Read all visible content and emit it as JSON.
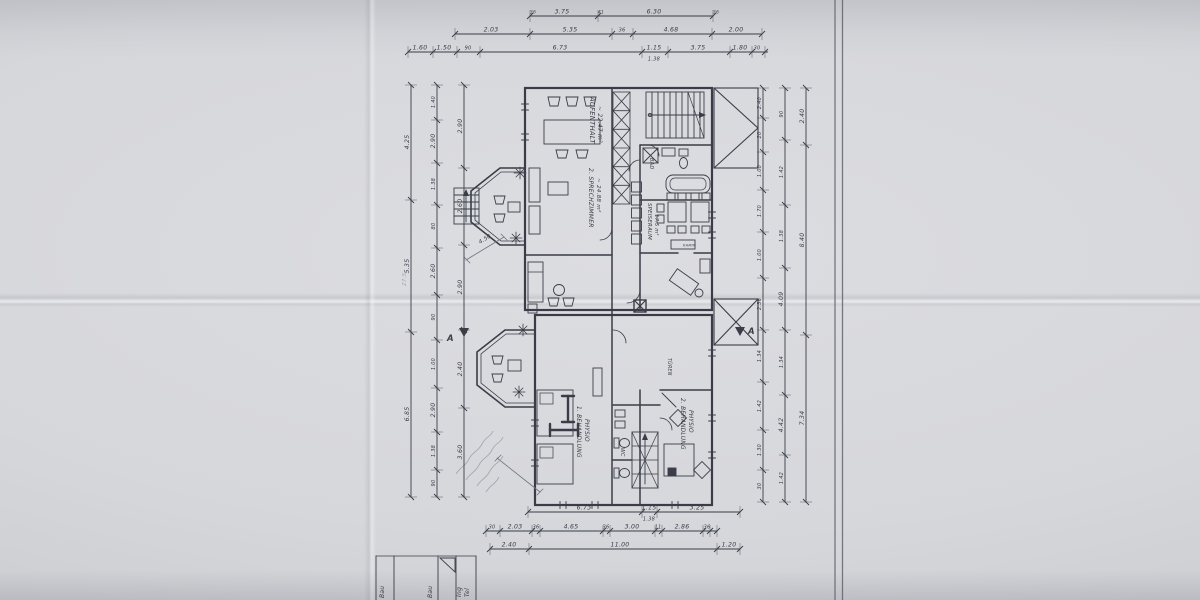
{
  "sheet": {
    "paper_color": "#d7d8dc",
    "ink_color": "#3a3d47",
    "light_ink_color": "#70737c",
    "pencil_color": "#a2a4ad",
    "border_color": "#62656e"
  },
  "plan": {
    "room_labels": [
      {
        "text": "AUFENTHALT",
        "x": 590,
        "y": 97,
        "rot": 90,
        "size": 6.8
      },
      {
        "text": "~ 22.47 m²",
        "x": 598,
        "y": 106,
        "rot": 90,
        "size": 6
      },
      {
        "text": "2. SPRECHZIMMER",
        "x": 589,
        "y": 168,
        "rot": 90,
        "size": 6
      },
      {
        "text": "~ 24.88 m²",
        "x": 597,
        "y": 178,
        "rot": 90,
        "size": 5.6
      },
      {
        "text": "SPEISERAUM",
        "x": 648,
        "y": 203,
        "rot": 90,
        "size": 5.4
      },
      {
        "text": "~ 17.5 m²",
        "x": 655,
        "y": 208,
        "rot": 90,
        "size": 5
      },
      {
        "text": "BAD",
        "x": 650,
        "y": 158,
        "rot": 90,
        "size": 5
      },
      {
        "text": "KAMIN",
        "x": 683,
        "y": 246.5,
        "rot": 0,
        "size": 3.6
      },
      {
        "text": "1. BEHANDLUNG",
        "x": 577,
        "y": 406,
        "rot": 90,
        "size": 5.8
      },
      {
        "text": "PHYSIO",
        "x": 585,
        "y": 419,
        "rot": 90,
        "size": 5.8
      },
      {
        "text": "2. BEHANDLUNG",
        "x": 681,
        "y": 398,
        "rot": 90,
        "size": 5.8
      },
      {
        "text": "PHYSIO",
        "x": 689,
        "y": 410,
        "rot": 90,
        "size": 5.8
      },
      {
        "text": "TÜREN",
        "x": 668,
        "y": 358,
        "rot": 90,
        "size": 4.8
      },
      {
        "text": "WC",
        "x": 621,
        "y": 448,
        "rot": 90,
        "size": 4.8
      }
    ],
    "annotations": [
      {
        "text": "A",
        "x": 447,
        "y": 341,
        "size": 8.5,
        "bold": true
      },
      {
        "text": "A",
        "x": 748,
        "y": 334,
        "size": 8.5,
        "bold": true
      },
      {
        "text": "4.50",
        "x": 480,
        "y": 244,
        "rot": -32,
        "size": 5.6
      },
      {
        "text": "27.5",
        "x": 406,
        "y": 286,
        "rot": -90,
        "size": 5.6,
        "pencil": true
      }
    ]
  },
  "dim_chains": {
    "horizontal": [
      {
        "y": 16,
        "a": 530,
        "b": 713,
        "ticks": [
          530,
          598,
          713
        ],
        "labels": [
          {
            "t": "3.75",
            "at": 562
          },
          {
            "t": "6.30",
            "at": 654
          },
          {
            "t": "36",
            "at": 533,
            "s": 4.5
          },
          {
            "t": "41",
            "at": 601,
            "s": 4.5
          },
          {
            "t": "36",
            "at": 716,
            "s": 4.5
          }
        ]
      },
      {
        "y": 34,
        "a": 455,
        "b": 762,
        "ticks": [
          455,
          530,
          612,
          633,
          712,
          762
        ],
        "labels": [
          {
            "t": "2.03",
            "at": 491
          },
          {
            "t": "5.35",
            "at": 570
          },
          {
            "t": "36",
            "at": 622,
            "s": 5
          },
          {
            "t": "4.68",
            "at": 671
          },
          {
            "t": "2.00",
            "at": 736
          }
        ]
      },
      {
        "y": 52,
        "a": 408,
        "b": 768,
        "ticks": [
          408,
          433,
          457,
          480,
          642,
          668,
          730,
          752,
          765
        ],
        "labels": [
          {
            "t": "1.60",
            "at": 420
          },
          {
            "t": "1.50",
            "at": 444
          },
          {
            "t": "90",
            "at": 468,
            "s": 5
          },
          {
            "t": "6.73",
            "at": 560
          },
          {
            "t": "1.15",
            "at": 654
          },
          {
            "t": "3.75",
            "at": 698
          },
          {
            "t": "1.80",
            "at": 740
          },
          {
            "t": "30",
            "at": 757,
            "s": 5
          }
        ],
        "sub": [
          {
            "t": "1.38",
            "at": 654
          }
        ]
      },
      {
        "y": 512,
        "a": 528,
        "b": 740,
        "ticks": [
          528,
          642,
          657,
          740
        ],
        "labels": [
          {
            "t": "6.73",
            "at": 584
          },
          {
            "t": "1.15",
            "at": 649
          },
          {
            "t": "3.25",
            "at": 697
          }
        ],
        "sub": [
          {
            "t": "1.38",
            "at": 649
          }
        ]
      },
      {
        "y": 531,
        "a": 486,
        "b": 717,
        "ticks": [
          486,
          500,
          532,
          540,
          603,
          610,
          655,
          662,
          703,
          710,
          717
        ],
        "labels": [
          {
            "t": "30",
            "at": 492,
            "s": 5
          },
          {
            "t": "2.03",
            "at": 515
          },
          {
            "t": "36",
            "at": 536,
            "s": 5
          },
          {
            "t": "4.65",
            "at": 571
          },
          {
            "t": "36",
            "at": 606,
            "s": 5
          },
          {
            "t": "3.00",
            "at": 632
          },
          {
            "t": "11",
            "at": 658,
            "s": 5
          },
          {
            "t": "2.86",
            "at": 682
          },
          {
            "t": "36",
            "at": 707,
            "s": 5
          }
        ]
      },
      {
        "y": 549,
        "a": 490,
        "b": 740,
        "ticks": [
          490,
          529,
          717,
          740
        ],
        "labels": [
          {
            "t": "2.40",
            "at": 509
          },
          {
            "t": "11.00",
            "at": 620
          },
          {
            "t": "1.20",
            "at": 729
          }
        ]
      }
    ],
    "vertical": [
      {
        "x": 411,
        "a": 85,
        "b": 497,
        "ticks": [
          85,
          200,
          332,
          497
        ],
        "labels": [
          {
            "t": "4.25",
            "at": 142
          },
          {
            "t": "5.35",
            "at": 266
          },
          {
            "t": "6.85",
            "at": 414
          }
        ]
      },
      {
        "x": 437,
        "a": 85,
        "b": 497,
        "ticks": [
          85,
          120,
          163,
          205,
          248,
          295,
          340,
          388,
          432,
          470,
          497
        ],
        "labels": [
          {
            "t": "1.40",
            "at": 102,
            "s": 5
          },
          {
            "t": "2.90",
            "at": 141
          },
          {
            "t": "1.38",
            "at": 184,
            "s": 5
          },
          {
            "t": "80",
            "at": 226,
            "s": 5
          },
          {
            "t": "2.60",
            "at": 271
          },
          {
            "t": "90",
            "at": 317,
            "s": 5
          },
          {
            "t": "1.00",
            "at": 364,
            "s": 5
          },
          {
            "t": "2.90",
            "at": 410
          },
          {
            "t": "1.38",
            "at": 451,
            "s": 5
          },
          {
            "t": "90",
            "at": 483,
            "s": 5
          }
        ]
      },
      {
        "x": 464,
        "a": 85,
        "b": 497,
        "ticks": [
          85,
          168,
          245,
          330,
          408,
          497
        ],
        "labels": [
          {
            "t": "2.90",
            "at": 126
          },
          {
            "t": "2.60",
            "at": 206
          },
          {
            "t": "2.90",
            "at": 287
          },
          {
            "t": "2.40",
            "at": 369
          },
          {
            "t": "3.60",
            "at": 452
          }
        ]
      },
      {
        "x": 763,
        "a": 88,
        "b": 502,
        "ticks": [
          88,
          118,
          152,
          190,
          232,
          278,
          330,
          382,
          430,
          470,
          502
        ],
        "labels": [
          {
            "t": "2.40",
            "at": 103,
            "s": 5
          },
          {
            "t": "20",
            "at": 135,
            "s": 5
          },
          {
            "t": "1.00",
            "at": 171,
            "s": 5
          },
          {
            "t": "1.70",
            "at": 211,
            "s": 5
          },
          {
            "t": "1.00",
            "at": 255,
            "s": 5
          },
          {
            "t": "2.36",
            "at": 304,
            "s": 5
          },
          {
            "t": "1.34",
            "at": 356,
            "s": 5
          },
          {
            "t": "1.42",
            "at": 406,
            "s": 5
          },
          {
            "t": "1.30",
            "at": 450,
            "s": 5
          },
          {
            "t": "30",
            "at": 486,
            "s": 5
          }
        ]
      },
      {
        "x": 785,
        "a": 88,
        "b": 502,
        "ticks": [
          88,
          140,
          205,
          268,
          330,
          395,
          455,
          502
        ],
        "labels": [
          {
            "t": "90",
            "at": 114,
            "s": 5
          },
          {
            "t": "1.42",
            "at": 172,
            "s": 5
          },
          {
            "t": "1.38",
            "at": 236,
            "s": 5
          },
          {
            "t": "4.09",
            "at": 299
          },
          {
            "t": "1.34",
            "at": 362,
            "s": 5
          },
          {
            "t": "4.42",
            "at": 425
          },
          {
            "t": "1.42",
            "at": 478,
            "s": 5
          }
        ]
      },
      {
        "x": 806,
        "a": 88,
        "b": 502,
        "ticks": [
          88,
          145,
          335,
          502
        ],
        "labels": [
          {
            "t": "2.40",
            "at": 116
          },
          {
            "t": "8.40",
            "at": 240
          },
          {
            "t": "7.34",
            "at": 418
          }
        ]
      }
    ]
  },
  "title_block": {
    "entries": [
      {
        "text": "Ing",
        "x": 461,
        "y": 597
      },
      {
        "text": "Tel",
        "x": 469,
        "y": 597
      },
      {
        "text": "Bau",
        "x": 432,
        "y": 598
      },
      {
        "text": "Bau",
        "x": 384,
        "y": 598
      }
    ]
  }
}
